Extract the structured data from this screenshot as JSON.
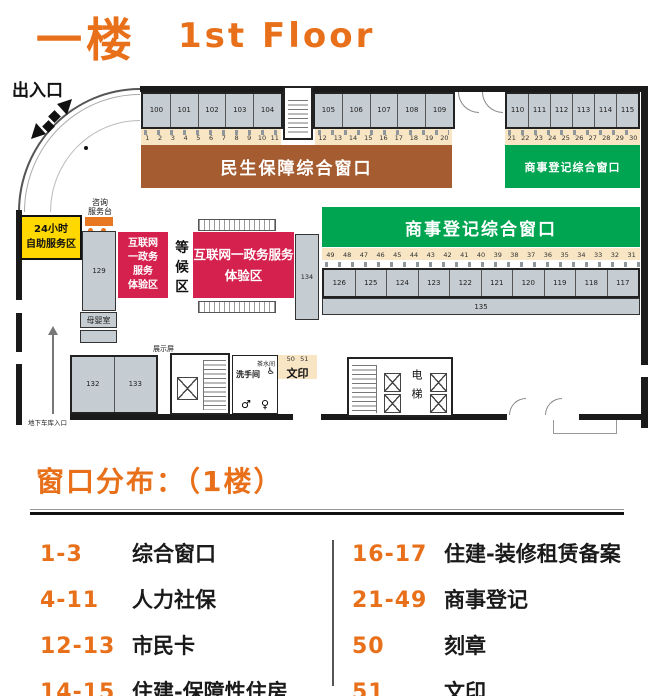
{
  "header": {
    "title_zh": "一楼",
    "title_en": "1st Floor"
  },
  "plan": {
    "entrance_label": "出入口",
    "garage_entrance_label": "地下车库入口",
    "self_service_lines": [
      "24小时",
      "自助服务区"
    ],
    "consult_desk_lines": [
      "咨询",
      "服务台"
    ],
    "waiting_area_label": "等候区",
    "nursery_label": "母婴室",
    "display_screen_label": "展示屏",
    "tea_room_label": "茶水间",
    "restroom_label": "洗手间",
    "restroom_icons": {
      "male": "♂",
      "female": "♀",
      "accessible": "♿"
    },
    "print_label": "文印",
    "print_windows": [
      "50",
      "51"
    ],
    "elevator_label": "电梯",
    "banners": {
      "livelihood": "民生保障综合窗口",
      "commerce_right": "商事登记综合窗口",
      "commerce_center": "商事登记综合窗口"
    },
    "experience_zone_small_lines": [
      "互联网",
      "一政务",
      "服务",
      "体验区"
    ],
    "experience_zone_large_lines": [
      "互联网一政务服务",
      "体验区"
    ],
    "rooms_top_left": [
      "100",
      "101",
      "102",
      "103",
      "104"
    ],
    "rooms_top_mid": [
      "105",
      "106",
      "107",
      "108",
      "109"
    ],
    "rooms_top_right": [
      "110",
      "111",
      "112",
      "113",
      "114",
      "115"
    ],
    "windows_left": [
      "1",
      "2",
      "3",
      "4",
      "5",
      "6",
      "7",
      "8",
      "9",
      "10",
      "11"
    ],
    "windows_mid": [
      "12",
      "13",
      "14",
      "15",
      "16",
      "17",
      "18",
      "19",
      "20"
    ],
    "windows_right": [
      "21",
      "22",
      "23",
      "24",
      "25",
      "26",
      "27",
      "28",
      "29",
      "30"
    ],
    "windows_center": [
      "49",
      "48",
      "47",
      "46",
      "45",
      "44",
      "43",
      "42",
      "41",
      "40",
      "39",
      "38",
      "37",
      "36",
      "35",
      "34",
      "33",
      "32",
      "31"
    ],
    "rooms_center": [
      "126",
      "125",
      "124",
      "123",
      "122",
      "121",
      "120",
      "119",
      "118",
      "117"
    ],
    "room_long_label": "135",
    "room_side_label": "134",
    "room_column_label": "129",
    "rooms_bottom_left": [
      "132",
      "133"
    ]
  },
  "legend": {
    "title": "窗口分布：（1楼）",
    "left": [
      {
        "range": "1-3",
        "label": "综合窗口"
      },
      {
        "range": "4-11",
        "label": "人力社保"
      },
      {
        "range": "12-13",
        "label": "市民卡"
      },
      {
        "range": "14-15",
        "label": "住建-保障性住房"
      }
    ],
    "right": [
      {
        "range": "16-17",
        "label": "住建-装修租赁备案"
      },
      {
        "range": "21-49",
        "label": "商事登记"
      },
      {
        "range": "50",
        "label": "刻章"
      },
      {
        "range": "51",
        "label": "文印"
      }
    ]
  },
  "colors": {
    "accent_orange": "#E8701A",
    "banner_brown": "#A55C30",
    "banner_green": "#00A551",
    "zone_red": "#D4214D",
    "zone_yellow": "#FFD800",
    "room_gray": "#C5CDD2",
    "counter_beige": "#F7E5C4"
  }
}
